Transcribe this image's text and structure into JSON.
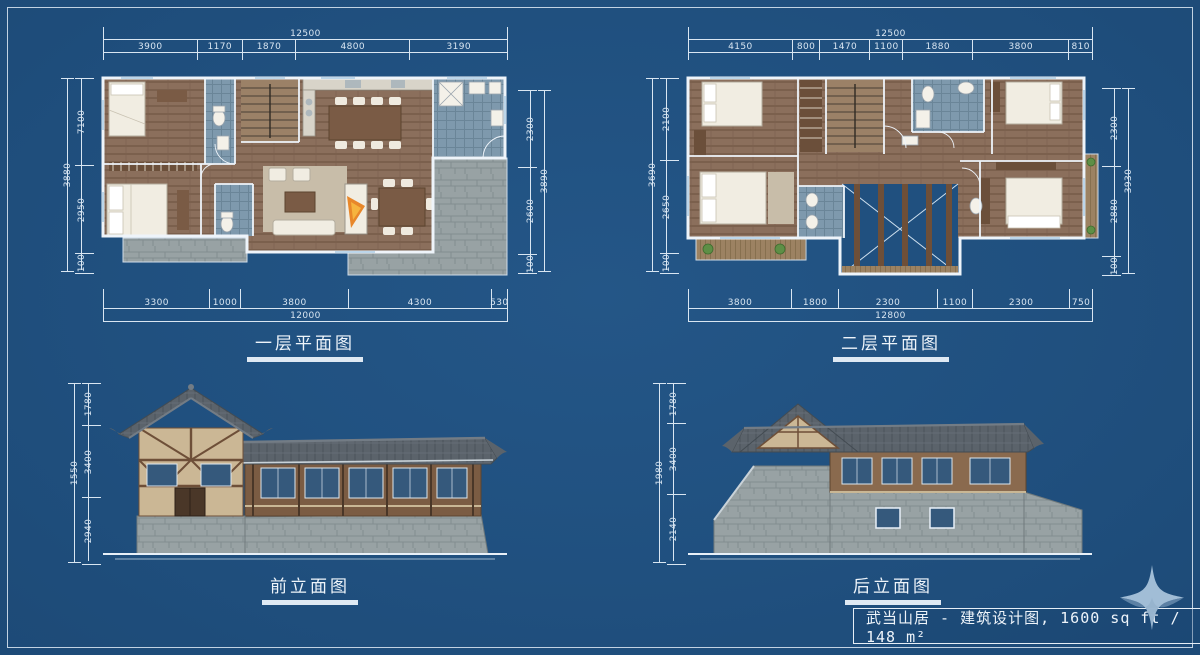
{
  "colors": {
    "background": "#20507f",
    "dimension_line": "#d9e6f2",
    "wood_floor": "#8b6f5c",
    "bathroom_tile": "#7e99ad",
    "stone": "#98a2a4",
    "roof": "#5b636b",
    "timber_dark": "#8a6a4e",
    "timber_light": "#cbb795",
    "fireplace_flame": "#e8872a",
    "logo": "#a9c3db"
  },
  "title_block": {
    "text": "武当山居 - 建筑设计图, 1600 sq ft / 148 m²"
  },
  "logo": {
    "icon": "four-pointed-star"
  },
  "drawings": [
    {
      "label": "一层平面图",
      "dims": {
        "top": {
          "total": "12500",
          "segments": [
            "3900",
            "1170",
            "1870",
            "4800",
            "3190"
          ]
        },
        "bottom": {
          "total": "12000",
          "segments": [
            "3300",
            "1000",
            "3800",
            "4300",
            "530"
          ]
        },
        "left": {
          "total": "3880",
          "segments": [
            "7100",
            "2950",
            "100"
          ]
        },
        "right": {
          "total": "3890",
          "segments": [
            "2300",
            "2600",
            "100"
          ]
        }
      }
    },
    {
      "label": "二层平面图",
      "dims": {
        "top": {
          "total": "12500",
          "segments": [
            "4150",
            "800",
            "1470",
            "1100",
            "1880",
            "3800",
            "810"
          ]
        },
        "bottom": {
          "total": "12800",
          "segments": [
            "3800",
            "1800",
            "2300",
            "1100",
            "2300",
            "750"
          ]
        },
        "left": {
          "total": "3690",
          "segments": [
            "2100",
            "2650",
            "100"
          ]
        },
        "right": {
          "total": "3930",
          "segments": [
            "2300",
            "2880",
            "100"
          ]
        }
      }
    },
    {
      "label": "前立面图",
      "dims": {
        "left": {
          "total": "1550",
          "segments": [
            "1780",
            "3400",
            "2940"
          ]
        }
      }
    },
    {
      "label": "后立面图",
      "dims": {
        "left": {
          "total": "1980",
          "segments": [
            "1780",
            "3400",
            "2140"
          ]
        }
      }
    }
  ]
}
